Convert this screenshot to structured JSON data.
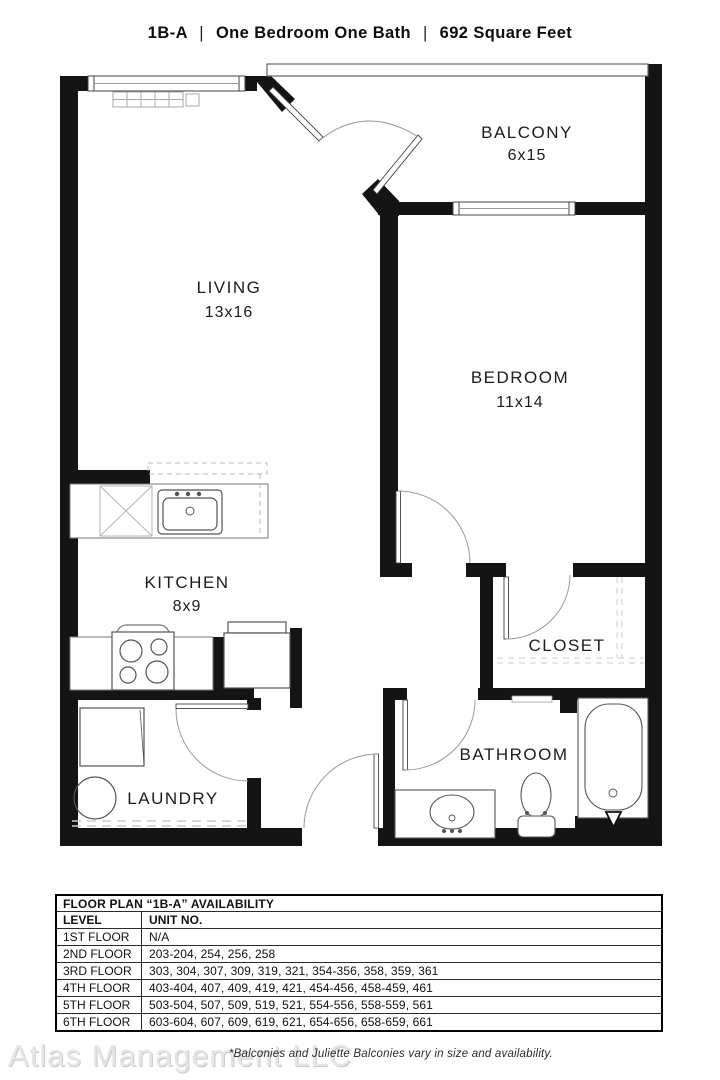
{
  "title": {
    "unit": "1B-A",
    "sep": "|",
    "type": "One Bedroom One Bath",
    "area": "692 Square Feet"
  },
  "plan": {
    "rooms": {
      "living": {
        "name": "LIVING",
        "dims": "13x16"
      },
      "balcony": {
        "name": "BALCONY",
        "dims": "6x15"
      },
      "bedroom": {
        "name": "BEDROOM",
        "dims": "11x14"
      },
      "kitchen": {
        "name": "KITCHEN",
        "dims": "8x9"
      },
      "closet": {
        "name": "CLOSET"
      },
      "bathroom": {
        "name": "BATHROOM"
      },
      "laundry": {
        "name": "LAUNDRY"
      }
    },
    "wall_color": "#141414",
    "line_color": "#666666"
  },
  "availability": {
    "header": "FLOOR PLAN “1B-A” AVAILABILITY",
    "columns": {
      "level": "LEVEL",
      "units": "UNIT NO."
    },
    "rows": [
      {
        "level": "1ST FLOOR",
        "units": "N/A"
      },
      {
        "level": "2ND FLOOR",
        "units": "203-204, 254, 256, 258"
      },
      {
        "level": "3RD FLOOR",
        "units": "303, 304, 307, 309, 319, 321, 354-356, 358, 359, 361"
      },
      {
        "level": "4TH FLOOR",
        "units": "403-404, 407, 409, 419, 421, 454-456, 458-459, 461"
      },
      {
        "level": "5TH FLOOR",
        "units": "503-504, 507, 509, 519, 521, 554-556, 558-559, 561"
      },
      {
        "level": "6TH FLOOR",
        "units": "603-604, 607, 609, 619, 621, 654-656, 658-659, 661"
      }
    ]
  },
  "footer": {
    "watermark": "Atlas Management LLC",
    "note": "*Balconies and Juliette Balconies vary in size and availability."
  }
}
